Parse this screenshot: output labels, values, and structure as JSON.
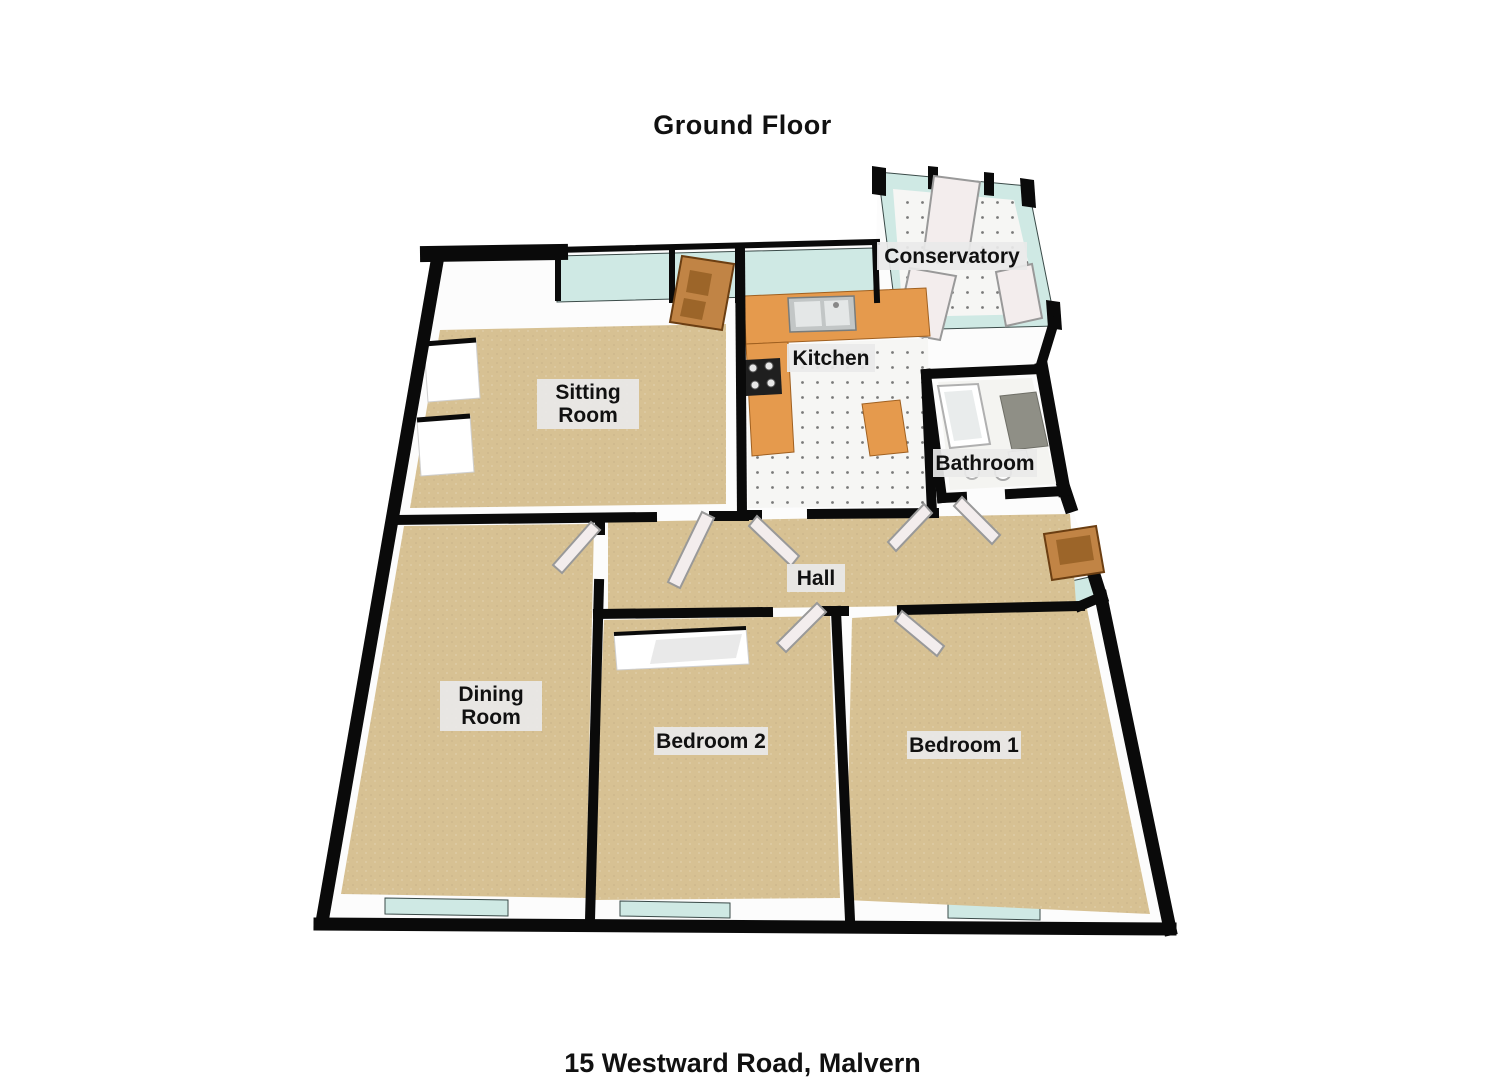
{
  "page": {
    "title": "Ground Floor",
    "address": "15 Westward Road, Malvern"
  },
  "rooms": [
    {
      "id": "conservatory",
      "lines": [
        "Conservatory"
      ]
    },
    {
      "id": "kitchen",
      "lines": [
        "Kitchen"
      ]
    },
    {
      "id": "sitting-room",
      "lines": [
        "Sitting",
        "Room"
      ]
    },
    {
      "id": "bathroom",
      "lines": [
        "Bathroom"
      ]
    },
    {
      "id": "hall",
      "lines": [
        "Hall"
      ]
    },
    {
      "id": "dining-room",
      "lines": [
        "Dining",
        "Room"
      ]
    },
    {
      "id": "bedroom-2",
      "lines": [
        "Bedroom 2"
      ]
    },
    {
      "id": "bedroom-1",
      "lines": [
        "Bedroom 1"
      ]
    }
  ],
  "colors": {
    "wall_black": "#0a0a0a",
    "wall_face": "#fcfcfc",
    "carpet": "#d7c193",
    "tile": "#f6f6f4",
    "glass": "#cfe9e4",
    "counter": "#e59a4d",
    "wood": "#c18445",
    "label_bg": "#e9e9e9",
    "text": "#111111"
  }
}
